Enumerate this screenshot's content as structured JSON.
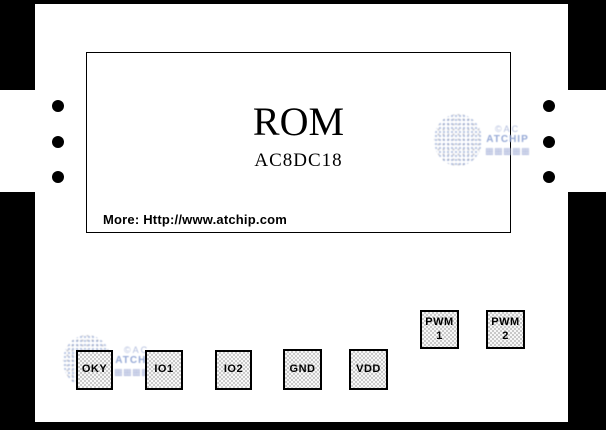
{
  "chip": {
    "title": "ROM",
    "part_number": "AC8DC18",
    "more_link": "More: Http://www.atchip.com"
  },
  "watermark": {
    "line1": "©AC",
    "line2": "ATCHIP",
    "line3": "▦▦▦▦▦"
  },
  "pads": [
    {
      "label": "OKY"
    },
    {
      "label": "IO1"
    },
    {
      "label": "IO2"
    },
    {
      "label": "GND"
    },
    {
      "label": "VDD"
    },
    {
      "label": "PWM",
      "sub": "1"
    },
    {
      "label": "PWM",
      "sub": "2"
    }
  ],
  "bond_dots": {
    "left": 3,
    "right": 3
  },
  "colors": {
    "frame": "#000000",
    "chip_body": "#ffffff",
    "pad_dither": "#c9c9c9",
    "text": "#000000",
    "watermark": "#a0b0d8"
  }
}
